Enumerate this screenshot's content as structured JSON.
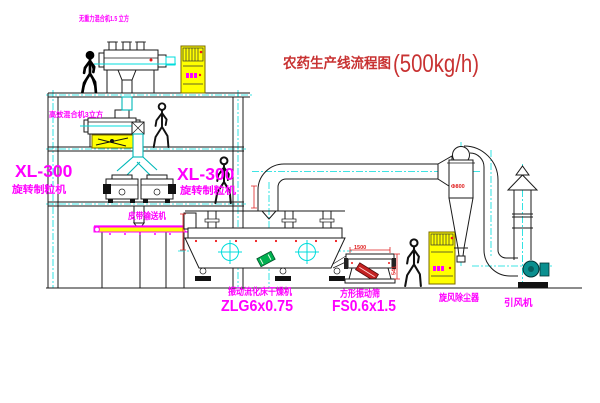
{
  "title": {
    "name_cn": "农药生产线流程图",
    "capacity": "(500kg/h)"
  },
  "equipment_labels": {
    "gravity_mixer": "无重力混合机1.5 立方",
    "high_efficiency_mixer": "高效混合机3立方",
    "granulator_left": {
      "model": "XL-300",
      "name": "旋转制粒机"
    },
    "granulator_right": {
      "model": "XL-300",
      "name": "旋转制粒机"
    },
    "belt_conveyor": "皮带输送机",
    "fluid_bed_dryer": {
      "name": "振动流化床干燥机",
      "model": "ZLG6x0.75"
    },
    "vibrating_sieve": {
      "name": "方形振动筛",
      "model": "FS0.6x1.5"
    },
    "cyclone_dust_collector": "旋风除尘器",
    "induced_draft_fan": "引风机"
  },
  "dimensions": {
    "sieve_length": "1500",
    "sieve_height": "541",
    "cyclone_diameter": "Φ800"
  },
  "colors": {
    "label_magenta": "#ff00ff",
    "title_red": "#c83232",
    "dimension_red": "#e02020",
    "centerline_cyan": "#00dcdc",
    "cabinet_yellow": "#ffff00",
    "fan_teal": "#0a8f8f",
    "belt_yellow": "#ffff00",
    "detail_green": "#00b050"
  }
}
